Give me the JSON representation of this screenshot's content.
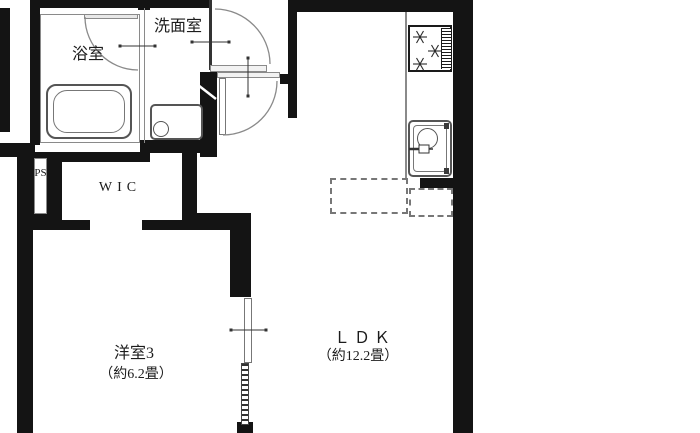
{
  "rooms": {
    "bathroom": {
      "label": "浴室"
    },
    "washroom": {
      "label": "洗面室"
    },
    "wic": {
      "label": "WIC"
    },
    "pipe_space": {
      "label": "PS"
    },
    "western_room": {
      "label": "洋室3",
      "size": "（約6.2畳）"
    },
    "ldk": {
      "label": "ＬＤＫ",
      "size": "（約12.2畳）"
    }
  },
  "colors": {
    "wall": "#141414",
    "fixture_line": "#555555",
    "background": "#ffffff"
  }
}
